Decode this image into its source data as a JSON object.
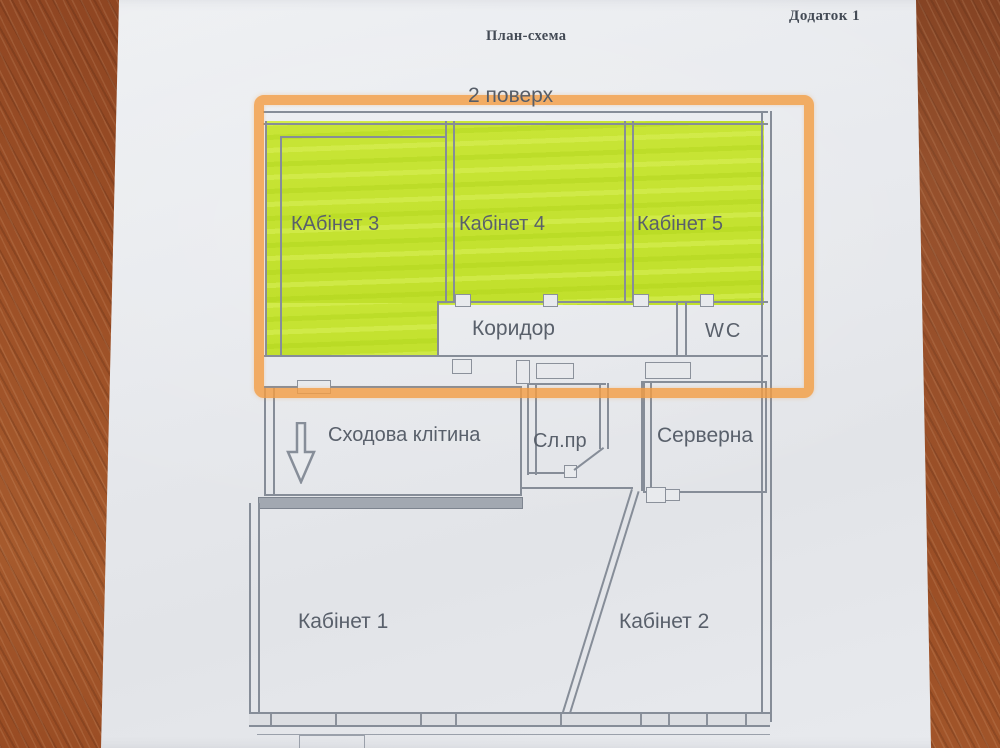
{
  "header": {
    "appendix": "Додаток 1",
    "title": "План-схема",
    "floor": "2 поверх"
  },
  "rooms": {
    "kabinet3": "КАбінет 3",
    "kabinet4": "Кабінет 4",
    "kabinet5": "Кабінет 5",
    "corridor": "Коридор",
    "wc": "WC",
    "stairwell": "Сходова клітина",
    "service": "Сл.пр",
    "server": "Серверна",
    "kabinet1": "Кабінет 1",
    "kabinet2": "Кабінет 2"
  },
  "highlights": {
    "marker_frame_color": "#f39e44",
    "rooms_fill_color": "#c5e231",
    "highlighted_rooms": [
      "КАбінет 3",
      "Кабінет 4",
      "Кабінет 5",
      "2 поверх"
    ]
  }
}
